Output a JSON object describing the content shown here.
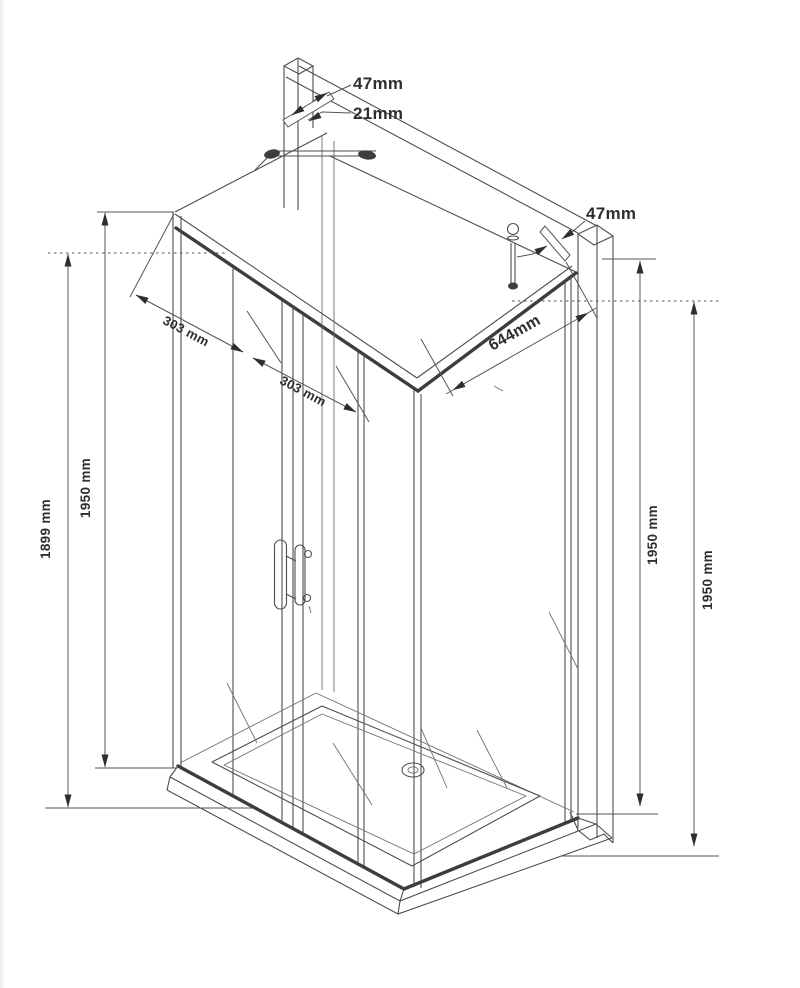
{
  "diagram": {
    "kind": "isometric technical line drawing",
    "subject": "corner shower enclosure with double sliding doors, side panel, wall profiles and shower tray",
    "colors": {
      "background": "#ffffff",
      "line": "#4d4d4d",
      "text": "#2e2e2e"
    }
  },
  "dims": {
    "top_profile_depth": "47mm",
    "top_profile_width": "21mm",
    "right_profile_depth": "47mm",
    "door_left": "303 mm",
    "door_right": "303 mm",
    "side_panel": "644mm",
    "height_glass": "1899 mm",
    "height_left": "1950 mm",
    "height_right_front": "1950 mm",
    "height_right_wall": "1950 mm"
  }
}
